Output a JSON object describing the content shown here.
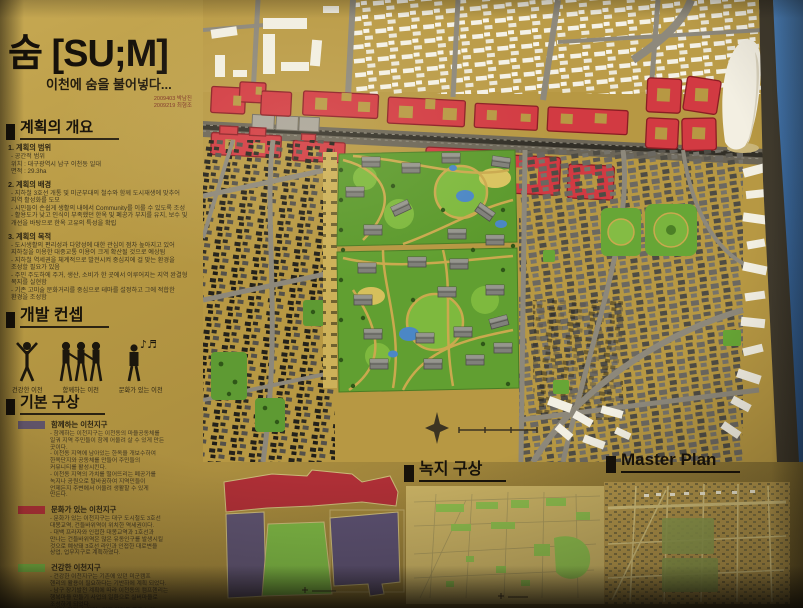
{
  "board": {
    "title": "숨 [SU;M]",
    "subtitle": "이천에 숨을 불어넣다...",
    "credits": [
      "2009403 박남진",
      "2009219 최형조"
    ]
  },
  "overview": {
    "heading": "계획의 개요",
    "items": [
      {
        "title": "1. 계획의 범위",
        "lines": [
          "- 공간적 범위",
          "   위치 : 대구광역시 남구 이천동 일대",
          "   면적 : 29.3ha"
        ]
      },
      {
        "title": "2. 계획의 배경",
        "lines": [
          "- 지하철 3호선 개통 및 미군부대의 철수와 함께 도시재생에 맞추어",
          "   지역 활성화를 도모",
          "- 시민들이 손쉽게 생활의 내에서 Community를 이룰 수 있도록 조성",
          "- 활용도가 낮고 인식이 부족했던 한옥 및 폐공가 부지를 유지, 보수 및",
          "   개선을 바탕으로 한옥 고유의 특성을 확립"
        ]
      },
      {
        "title": "3. 계획의 목적",
        "lines": [
          "- 도시생활의 편리성과 다양성에 대한 관심이 점차 높아지고 있어",
          "   지하철을 이용한 대중교통 이용이 크게 확산될 것으로 예상됨",
          "- 지하철 역세권을 체계적으로 발전시켜 중심지에 걸 맞는 환경을",
          "   조성할 필요가 있음",
          "- 주민 주도하에 주거, 생산, 소비가 한 곳에서 이루어지는 지역 완결형",
          "   복지를 실현함",
          "- 기존 고미술 문화거리를 중심으로 테마를 설정하고 그에 적합한",
          "   환경을 조성함"
        ]
      }
    ]
  },
  "concept": {
    "heading": "개발 컨셉",
    "items": [
      {
        "label": "건강한 이천",
        "icon": "person-arms-raised-icon"
      },
      {
        "label": "함께하는 이천",
        "icon": "people-holding-hands-icon"
      },
      {
        "label": "문화가 있는 이천",
        "icon": "person-music-icon"
      }
    ]
  },
  "basic": {
    "heading": "기본 구상",
    "districts": [
      {
        "color": "#63566c",
        "title": "함께하는 이천지구",
        "lines": [
          "- 함께하는 이천지구는 이천동의 마을공동체를",
          "  일궈 지역 주민들이 함께 어울려 살 수 있게 만든",
          "  곳이다.",
          "- 이천동 지역에 남아있는 한옥을 개보수하여",
          "  한옥단지와 공동체를 만들어 주민들의",
          "  커뮤니티를 활성시킨다.",
          "- 이천동 지역의 가치를 떨어뜨리는 폐공가를",
          "  녹지나 공원으로 탈바꿈하여 지역민들이",
          "  언제든지 주변에서 어울려 생활할 수 있게",
          "  만든다."
        ]
      },
      {
        "color": "#b23238",
        "title": "문화가 있는 이천지구",
        "lines": [
          "- 문화가 있는 이천지구는 대구 도시철도 3호선",
          "  대봉교역, 건들바위역이 위치한 역세권이다.",
          "- 대백 프라자와 인접한 대봉교역과 1호선과",
          "  만나는 건들바위역은 많은 유동인구를 발생시킬",
          "  것으로 예상돼 3호선 라인과 인접한 대로변을",
          "  상업, 업무지구로 계획하였다."
        ]
      },
      {
        "color": "#74ae41",
        "title": "건강한 이천지구",
        "lines": [
          "- 건강한 이천지구는 기존에 있던 미군캠프",
          "  헨리의 활용이 필요하다는 기반하에 계획 되었다.",
          "- 남구 장기발전 계획에 따라 이천동의 캠프헨리는",
          "  행복마을 만들기 사업의 일환으로 실버마을로",
          "  조성하게 되었다.",
          "- 쉼터, 일터, 놀이터 3가지 영역을 모둔 노인",
          "  주도적 실버 빌리지를 조성하여 건강한 노년",
          "  생활을 보낼 수 있는 단지로 계획하였다."
        ]
      }
    ]
  },
  "green_plan": {
    "heading": "녹지 구상"
  },
  "master_plan": {
    "heading": "Master Plan"
  },
  "colors": {
    "board_tan": "#b3953f",
    "red_building": "#d8414b",
    "park_green": "#5f9c2e",
    "pond_blue": "#4b87c6",
    "wall_blue": "#3f74ae",
    "district_together": "#63566c",
    "district_culture": "#b23238",
    "district_healthy": "#74ae41"
  }
}
